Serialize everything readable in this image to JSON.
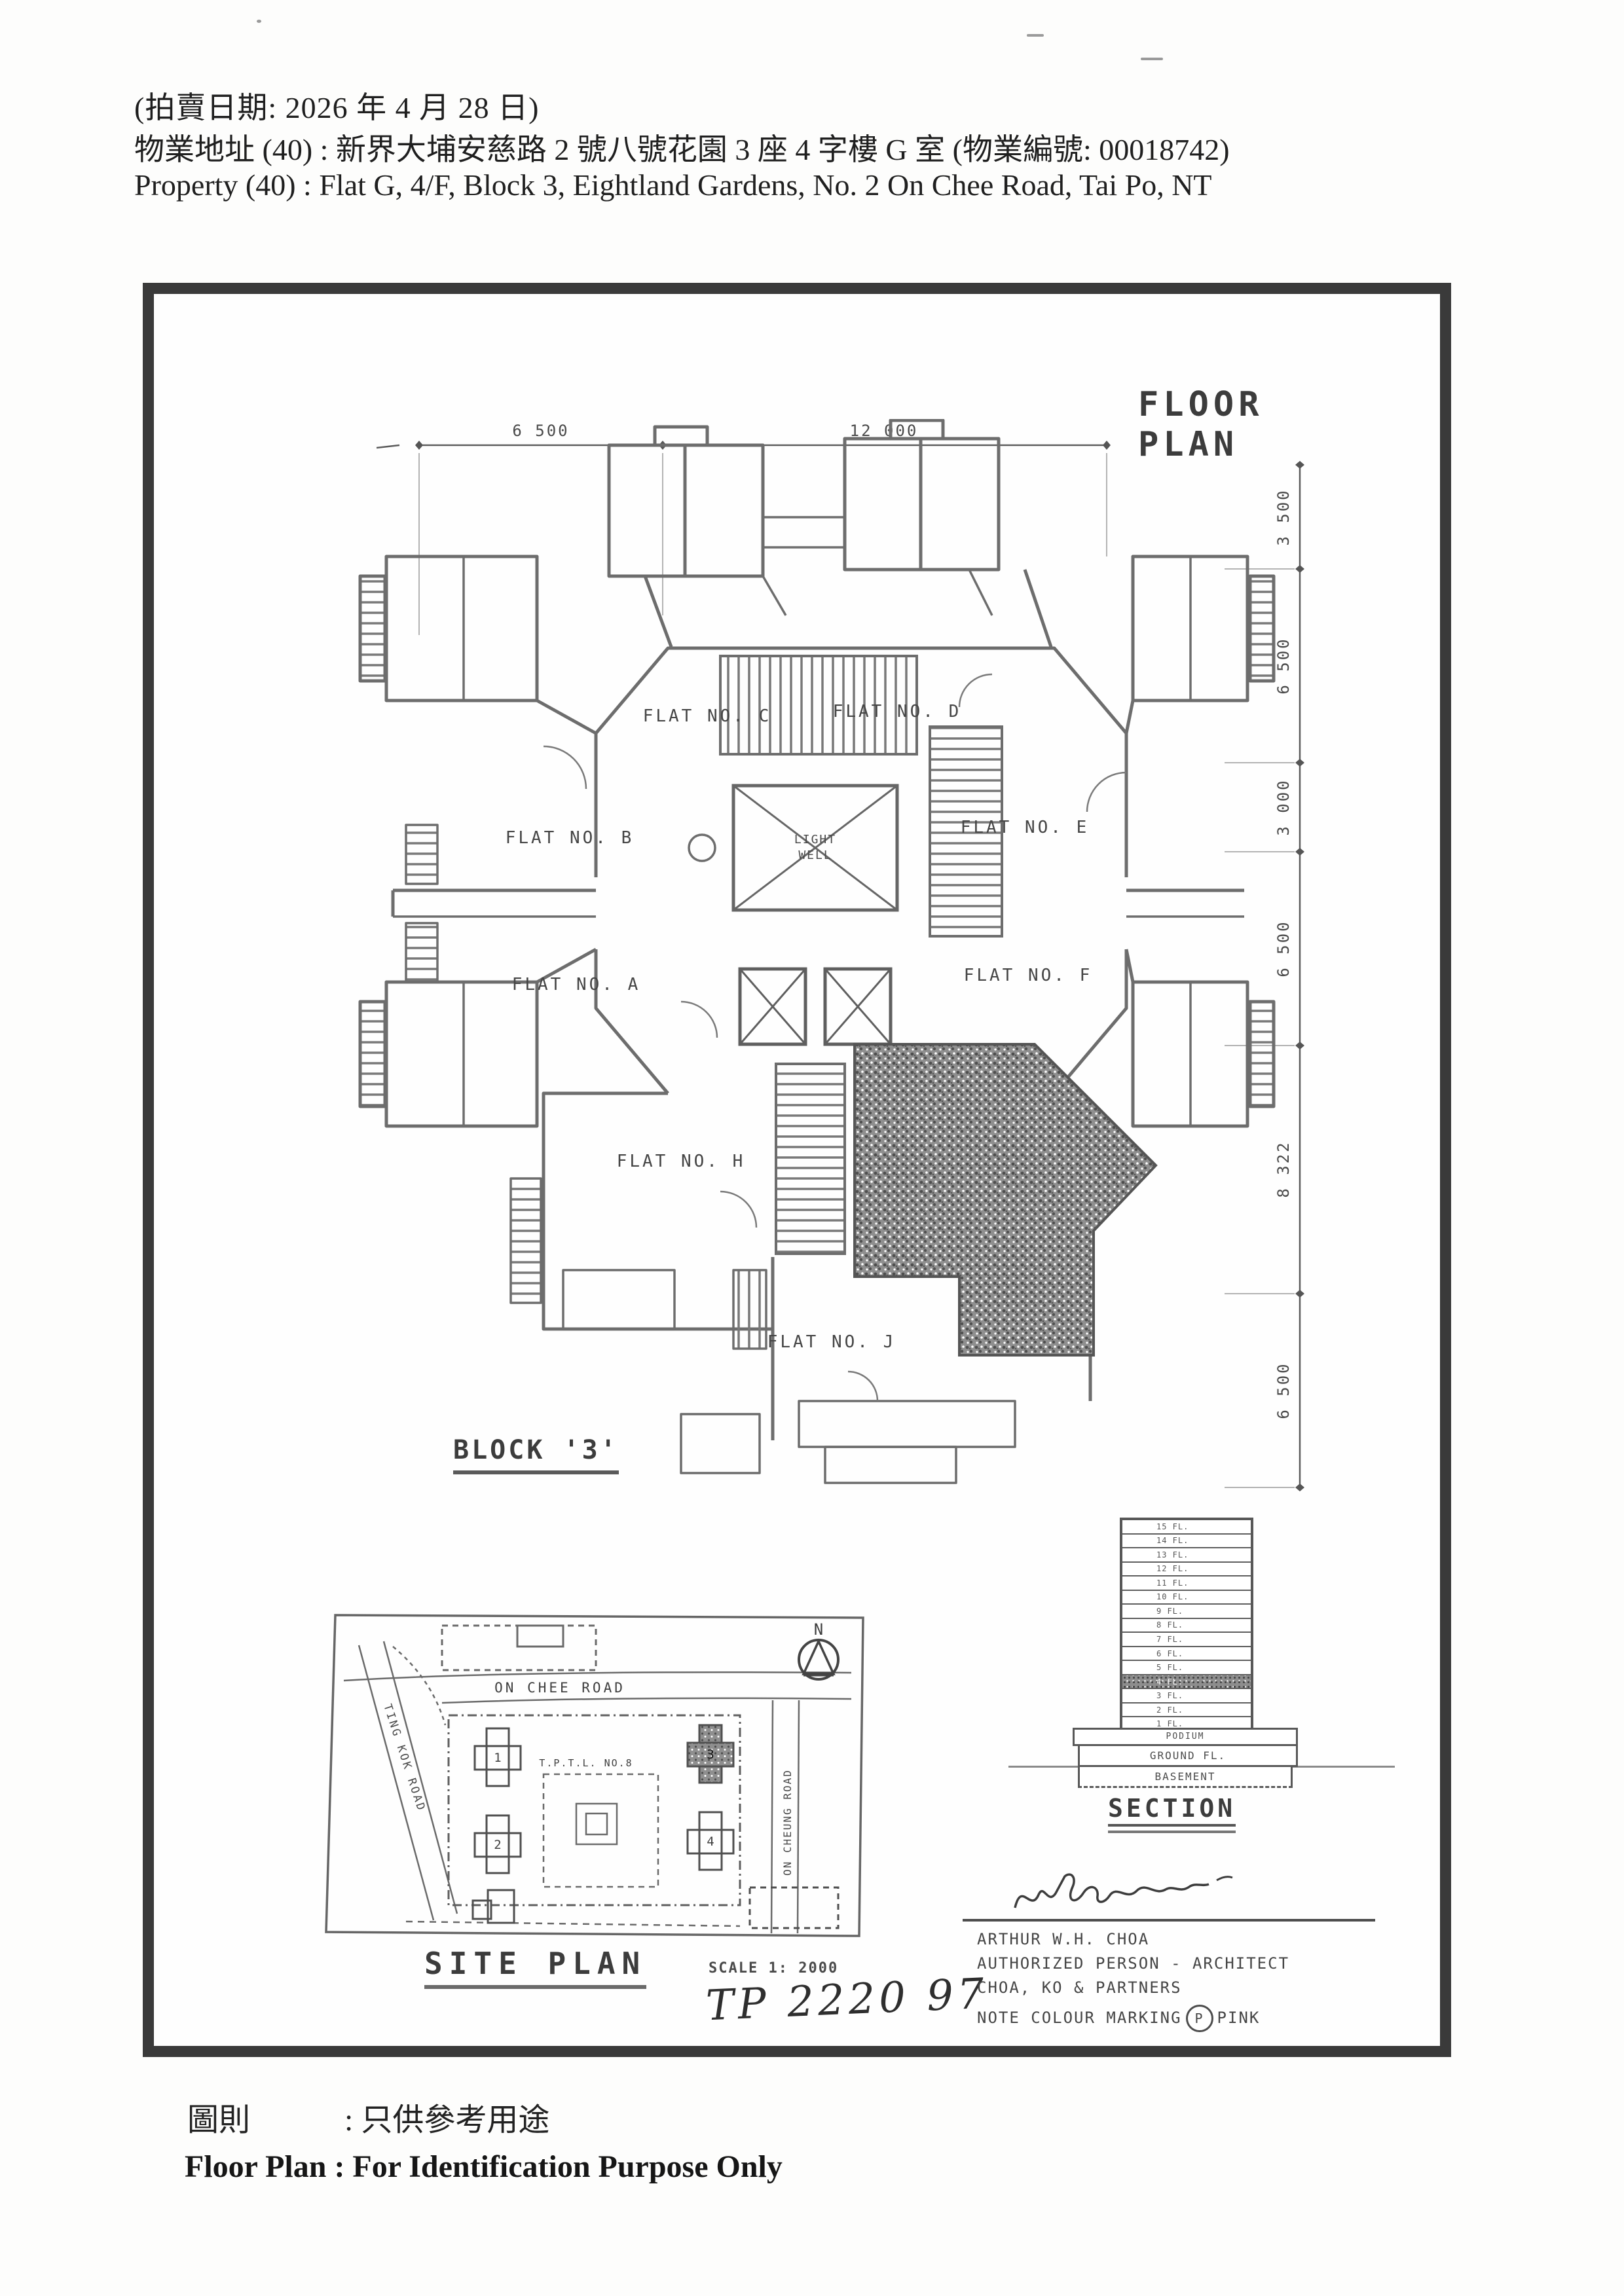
{
  "header": {
    "line1": "(拍賣日期:   2026 年 4 月 28 日)",
    "line2": "物業地址 (40) :   新界大埔安慈路 2 號八號花園 3 座 4 字樓 G 室  (物業編號: 00018742)",
    "line3": "Property   (40) :   Flat G, 4/F, Block 3, Eightland Gardens, No. 2 On Chee Road, Tai Po, NT"
  },
  "floor_plan": {
    "title": "FLOOR PLAN",
    "block_label": "BLOCK '3'",
    "light_well": {
      "line1": "LIGHT",
      "line2": "WELL"
    },
    "flats": {
      "c": "FLAT NO. C",
      "d": "FLAT NO. D",
      "b": "FLAT NO. B",
      "e": "FLAT NO. E",
      "a": "FLAT NO. A",
      "f": "FLAT NO. F",
      "h": "FLAT NO. H",
      "j": "FLAT NO. J"
    },
    "dims_top": [
      "6 500",
      "12 000"
    ],
    "dims_right": [
      "3 500",
      "6 500",
      "3 000",
      "6 500",
      "8 322",
      "6 500"
    ]
  },
  "site_plan": {
    "title": "SITE PLAN",
    "scale": "SCALE 1: 2000",
    "roads": {
      "top": "ON CHEE ROAD",
      "left": "TING KOK ROAD",
      "right": "ON CHEUNG ROAD"
    },
    "lot_label": "T.P.T.L. NO.8",
    "north_label": "N",
    "block_numbers": [
      "1",
      "2",
      "3",
      "4"
    ],
    "handwritten_ref": "TP 2220 97"
  },
  "section": {
    "title": "SECTION",
    "floors": [
      {
        "label": "15 FL."
      },
      {
        "label": "14 FL."
      },
      {
        "label": "13 FL."
      },
      {
        "label": "12 FL."
      },
      {
        "label": "11 FL."
      },
      {
        "label": "10 FL."
      },
      {
        "label": "9 FL."
      },
      {
        "label": "8 FL."
      },
      {
        "label": "7 FL."
      },
      {
        "label": "6 FL."
      },
      {
        "label": "5 FL."
      },
      {
        "label": "4 FL.",
        "hatched": true
      },
      {
        "label": "3 FL."
      },
      {
        "label": "2 FL."
      },
      {
        "label": "1 FL."
      }
    ],
    "podium": "PODIUM",
    "ground": "GROUND FL.",
    "basement": "BASEMENT"
  },
  "architect": {
    "name": "ARTHUR W.H. CHOA",
    "role": "AUTHORIZED PERSON - ARCHITECT",
    "firm": "CHOA, KO & PARTNERS",
    "note_prefix": "NOTE COLOUR MARKING",
    "note_symbol": "P",
    "note_suffix": "PINK"
  },
  "footer": {
    "zh_label": "圖則",
    "zh_colon": ":",
    "zh_text": "只供參考用途",
    "en_text": "Floor Plan : For Identification Purpose Only"
  },
  "colors": {
    "ink": "#3d3d3d",
    "line": "#6e6e6e",
    "frame": "#3a3a3a",
    "marking": "pink"
  }
}
